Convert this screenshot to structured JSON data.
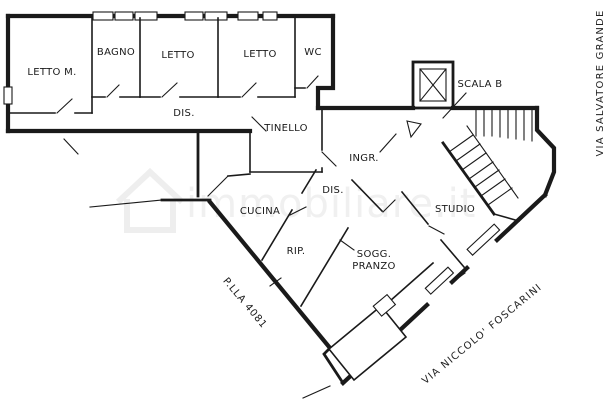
{
  "floorplan": {
    "rooms": {
      "letto_m": "LETTO M.",
      "bagno": "BAGNO",
      "letto1": "LETTO",
      "letto2": "LETTO",
      "wc": "WC",
      "dis1": "DIS.",
      "tinello": "TINELLO",
      "ingr": "INGR.",
      "scala": "SCALA B",
      "dis2": "DIS.",
      "cucina": "CUCINA",
      "rip": "RIP.",
      "sogg_line1": "SOGG.",
      "sogg_line2": "PRANZO",
      "studio": "STUDIO"
    },
    "annotations": {
      "parcel": "P.LLA 4081",
      "street_bottom": "VIA NICCOLO' FOSCARINI",
      "street_right": "VIA SALVATORE GRANDE"
    },
    "watermark": "immobiliare.it",
    "colors": {
      "wall": "#1a1a1a",
      "background": "#ffffff",
      "watermark": "#bfbfbf"
    }
  }
}
